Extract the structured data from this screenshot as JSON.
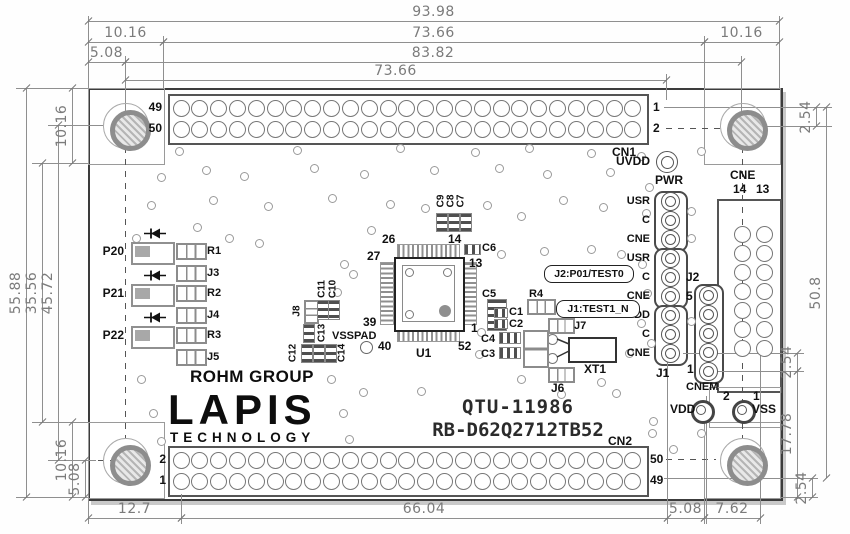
{
  "drawing": {
    "logo": {
      "group": "ROHM GROUP",
      "main": "LAPIS",
      "sub": "TECHNOLOGY"
    },
    "part_number": "QTU-11986",
    "model": "RB-D62Q2712TB52"
  },
  "cn1": {
    "name": "CN1",
    "pin_tl": "49",
    "pin_bl": "50",
    "pin_tr": "1",
    "pin_br": "2"
  },
  "cn2": {
    "name": "CN2",
    "pin_tl": "2",
    "pin_bl": "1",
    "pin_tr": "50",
    "pin_br": "49"
  },
  "cne": {
    "name": "CNE",
    "pin_left": "14",
    "pin_right": "13"
  },
  "cnem": {
    "name": "CNEM",
    "pin_top": "5",
    "pin_bottom": "1"
  },
  "pwr_header": {
    "name": "PWR",
    "pin_labels": [
      "USR",
      "C",
      "CNE",
      "USR",
      "C",
      "CNE",
      "VDD",
      "C",
      "CNE"
    ],
    "j2_label": "J2",
    "j1_label": "J1",
    "pin1": "1"
  },
  "notes": {
    "j2": "J2:P01/TEST0",
    "j1": "J1:TEST1_N"
  },
  "testpoints": {
    "uvdd": "UVDD",
    "vdd": "VDD",
    "vss": "VSS",
    "vdd_pin": "2",
    "vss_pin": "1"
  },
  "ic": {
    "ref": "U1",
    "pad": "VSSPAD",
    "pin_top_left": "26",
    "pin_top_right": "14",
    "pin_right_top": "13",
    "pin_right_bottom": "1",
    "pin_left_top": "27",
    "pin_left_bottom": "39",
    "pin_bottom_left": "40",
    "pin_bottom_right": "52"
  },
  "leds": [
    {
      "ref": "P20",
      "res": "R1",
      "jmp": "J3"
    },
    {
      "ref": "P21",
      "res": "R2",
      "jmp": "J4"
    },
    {
      "ref": "P22",
      "res": "R3",
      "jmp": "J5"
    }
  ],
  "parts": {
    "c1": "C1",
    "c2": "C2",
    "c3": "C3",
    "c4": "C4",
    "c5": "C5",
    "c6": "C6",
    "c7": "C7",
    "c8": "C8",
    "c9": "C9",
    "c10": "C10",
    "c11": "C11",
    "c12": "C12",
    "c13": "C13",
    "c14": "C14",
    "r4": "R4",
    "j6": "J6",
    "j7": "J7",
    "j8": "J8",
    "xt1": "XT1"
  },
  "dims": [
    {
      "v": "93.98",
      "a": "h",
      "p": 21,
      "f": 88,
      "t": 779
    },
    {
      "v": "10.16",
      "a": "h",
      "p": 42,
      "f": 88,
      "t": 163
    },
    {
      "v": "73.66",
      "a": "h",
      "p": 42,
      "f": 163,
      "t": 704
    },
    {
      "v": "10.16",
      "a": "h",
      "p": 42,
      "f": 704,
      "t": 779
    },
    {
      "v": "5.08",
      "a": "h",
      "p": 62,
      "f": 88,
      "t": 125
    },
    {
      "v": "83.82",
      "a": "h",
      "p": 62,
      "f": 125,
      "t": 741
    },
    {
      "v": "73.66",
      "a": "h",
      "p": 80,
      "f": 125,
      "t": 666
    },
    {
      "v": "55.88",
      "a": "v",
      "p": 26,
      "f": 88,
      "t": 497
    },
    {
      "v": "35.56",
      "a": "v",
      "p": 42,
      "f": 163,
      "t": 422
    },
    {
      "v": "45.72",
      "a": "v",
      "p": 58,
      "f": 125,
      "t": 460
    },
    {
      "v": "10.16",
      "a": "v",
      "p": 72,
      "f": 88,
      "t": 163
    },
    {
      "v": "10.16",
      "a": "v",
      "p": 72,
      "f": 422,
      "t": 497
    },
    {
      "v": "5.08",
      "a": "v",
      "p": 85,
      "f": 460,
      "t": 497
    },
    {
      "v": "2.54",
      "a": "v",
      "p": 816,
      "f": 107,
      "t": 126
    },
    {
      "v": "50.8",
      "a": "v",
      "p": 826,
      "f": 107,
      "t": 478
    },
    {
      "v": "2.54",
      "a": "v",
      "p": 797,
      "f": 353,
      "t": 371
    },
    {
      "v": "17.78",
      "a": "v",
      "p": 797,
      "f": 371,
      "t": 497
    },
    {
      "v": "2.54",
      "a": "v",
      "p": 812,
      "f": 478,
      "t": 497
    },
    {
      "v": "12.7",
      "a": "h",
      "p": 518,
      "f": 88,
      "t": 181
    },
    {
      "v": "66.04",
      "a": "h",
      "p": 518,
      "f": 181,
      "t": 667
    },
    {
      "v": "5.08",
      "a": "h",
      "p": 518,
      "f": 667,
      "t": 704
    },
    {
      "v": "7.62",
      "a": "h",
      "p": 518,
      "f": 704,
      "t": 760
    }
  ]
}
